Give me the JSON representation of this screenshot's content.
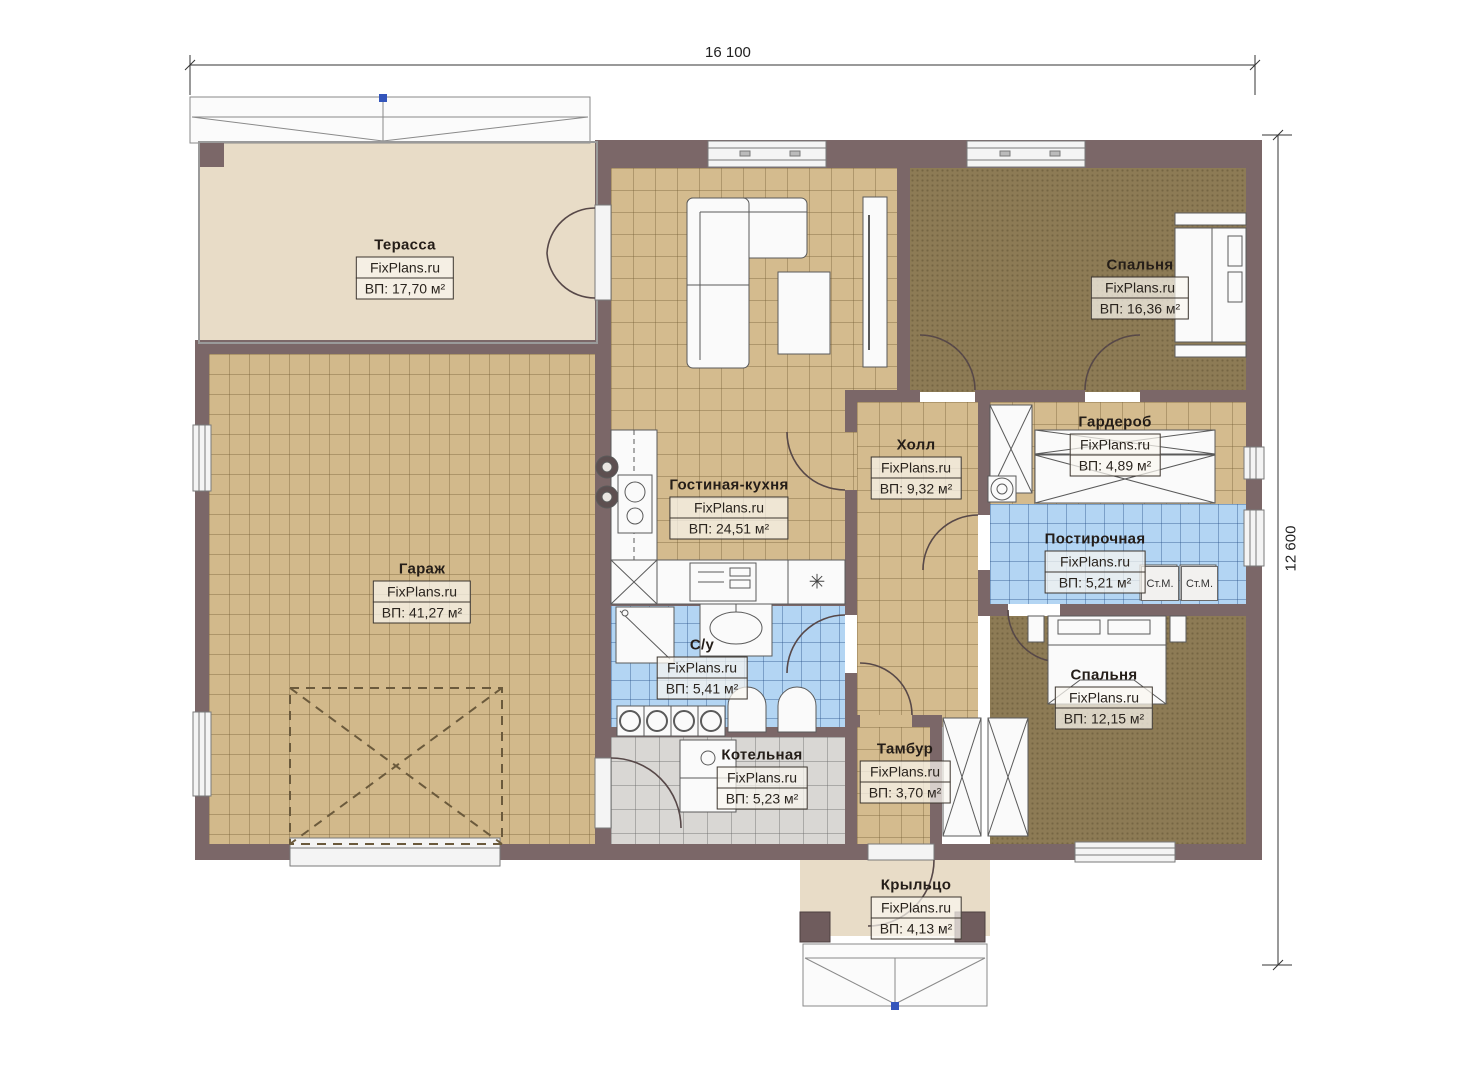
{
  "plan": {
    "brand": "FixPlans.ru",
    "dimensions": {
      "width_label": "16 100",
      "height_label": "12 600"
    },
    "washer_label": "Ст.М.",
    "symbols": {
      "fridge": "✳"
    },
    "rooms": [
      {
        "name": "Терасса",
        "watermark": "FixPlans.ru",
        "area": "ВП: 17,70 м²"
      },
      {
        "name": "Гараж",
        "watermark": "FixPlans.ru",
        "area": "ВП: 41,27 м²"
      },
      {
        "name": "Гостиная-кухня",
        "watermark": "FixPlans.ru",
        "area": "ВП: 24,51 м²"
      },
      {
        "name": "Спальня",
        "watermark": "FixPlans.ru",
        "area": "ВП: 16,36 м²"
      },
      {
        "name": "Холл",
        "watermark": "FixPlans.ru",
        "area": "ВП: 9,32 м²"
      },
      {
        "name": "Гардероб",
        "watermark": "FixPlans.ru",
        "area": "ВП: 4,89 м²"
      },
      {
        "name": "Постирочная",
        "watermark": "FixPlans.ru",
        "area": "ВП: 5,21 м²"
      },
      {
        "name": "С/у",
        "watermark": "FixPlans.ru",
        "area": "ВП: 5,41 м²"
      },
      {
        "name": "Котельная",
        "watermark": "FixPlans.ru",
        "area": "ВП: 5,23 м²"
      },
      {
        "name": "Тамбур",
        "watermark": "FixPlans.ru",
        "area": "ВП: 3,70 м²"
      },
      {
        "name": "Спальня",
        "watermark": "FixPlans.ru",
        "area": "ВП: 12,15 м²"
      },
      {
        "name": "Крыльцо",
        "watermark": "FixPlans.ru",
        "area": "ВП: 4,13 м²"
      }
    ],
    "colors": {
      "wall": "#7b6768",
      "floor_tan": "#d4bb8e",
      "floor_dark": "#8d7b55",
      "floor_blue": "#b3d5f3",
      "floor_gray": "#d9d7d4",
      "floor_plain": "#e8dcc7",
      "roof_marker_blue": "#3355bb"
    }
  }
}
